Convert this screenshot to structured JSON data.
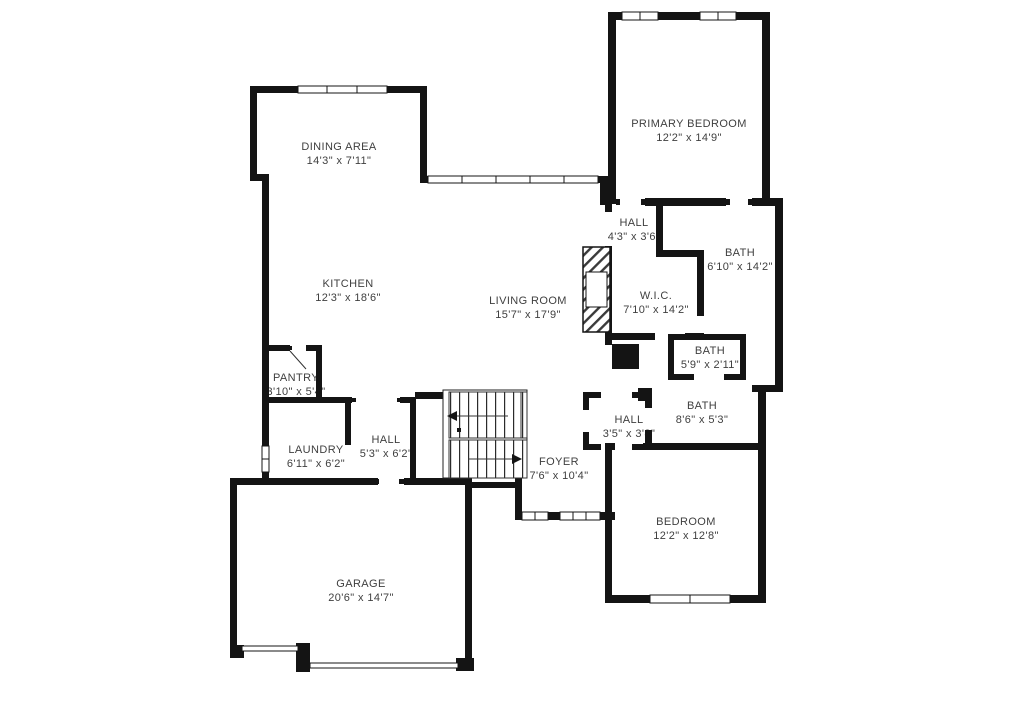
{
  "meta": {
    "title": "Residential floor plan",
    "background_color": "#ffffff",
    "wall_color": "#141414",
    "text_color": "#3f3f3f"
  },
  "rooms": [
    {
      "name": "DINING AREA",
      "dims": "14'3\" x 7'11\""
    },
    {
      "name": "KITCHEN",
      "dims": "12'3\" x 18'6\""
    },
    {
      "name": "LIVING ROOM",
      "dims": "15'7\" x 17'9\""
    },
    {
      "name": "PRIMARY BEDROOM",
      "dims": "12'2\" x 14'9\""
    },
    {
      "name": "HALL",
      "dims": "4'3\" x 3'6\""
    },
    {
      "name": "BATH",
      "dims": "6'10\" x 14'2\""
    },
    {
      "name": "W.I.C.",
      "dims": "7'10\" x 14'2\""
    },
    {
      "name": "BATH",
      "dims": "5'9\" x 2'11\""
    },
    {
      "name": "BATH",
      "dims": "8'6\" x 5'3\""
    },
    {
      "name": "HALL",
      "dims": "3'5\" x 3'8\""
    },
    {
      "name": "PANTRY",
      "dims": "3'10\" x 5'4\""
    },
    {
      "name": "LAUNDRY",
      "dims": "6'11\" x 6'2\""
    },
    {
      "name": "HALL",
      "dims": "5'3\" x 6'2\""
    },
    {
      "name": "FOYER",
      "dims": "7'6\" x 10'4\""
    },
    {
      "name": "BEDROOM",
      "dims": "12'2\" x 12'8\""
    },
    {
      "name": "GARAGE",
      "dims": "20'6\" x 14'7\""
    }
  ]
}
